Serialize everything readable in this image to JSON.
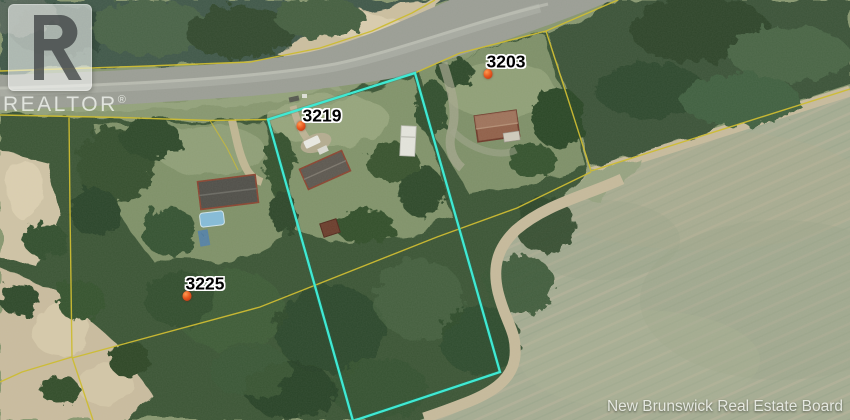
{
  "watermark": {
    "brand": "REALTOR",
    "registered_mark": "®",
    "logo_letter": "R"
  },
  "attribution": {
    "text": "New Brunswick Real Estate Board"
  },
  "map": {
    "type": "aerial-photo-with-parcel-overlay",
    "highlighted_parcel": "3219",
    "parcels": [
      {
        "number": "3203",
        "label": {
          "x": 506,
          "y": 62
        },
        "marker": {
          "x": 488,
          "y": 74
        }
      },
      {
        "number": "3219",
        "label": {
          "x": 322,
          "y": 116
        },
        "marker": {
          "x": 301,
          "y": 126
        }
      },
      {
        "number": "3225",
        "label": {
          "x": 205,
          "y": 284
        },
        "marker": {
          "x": 187,
          "y": 296
        }
      }
    ],
    "colors": {
      "highlight_boundary": "#3fe9d3",
      "parcel_line": "#cdbc33",
      "marker_fill": "#e85a20",
      "marker_core": "#b32c10",
      "label_text": "#000000",
      "label_halo": "#ffffff"
    }
  }
}
